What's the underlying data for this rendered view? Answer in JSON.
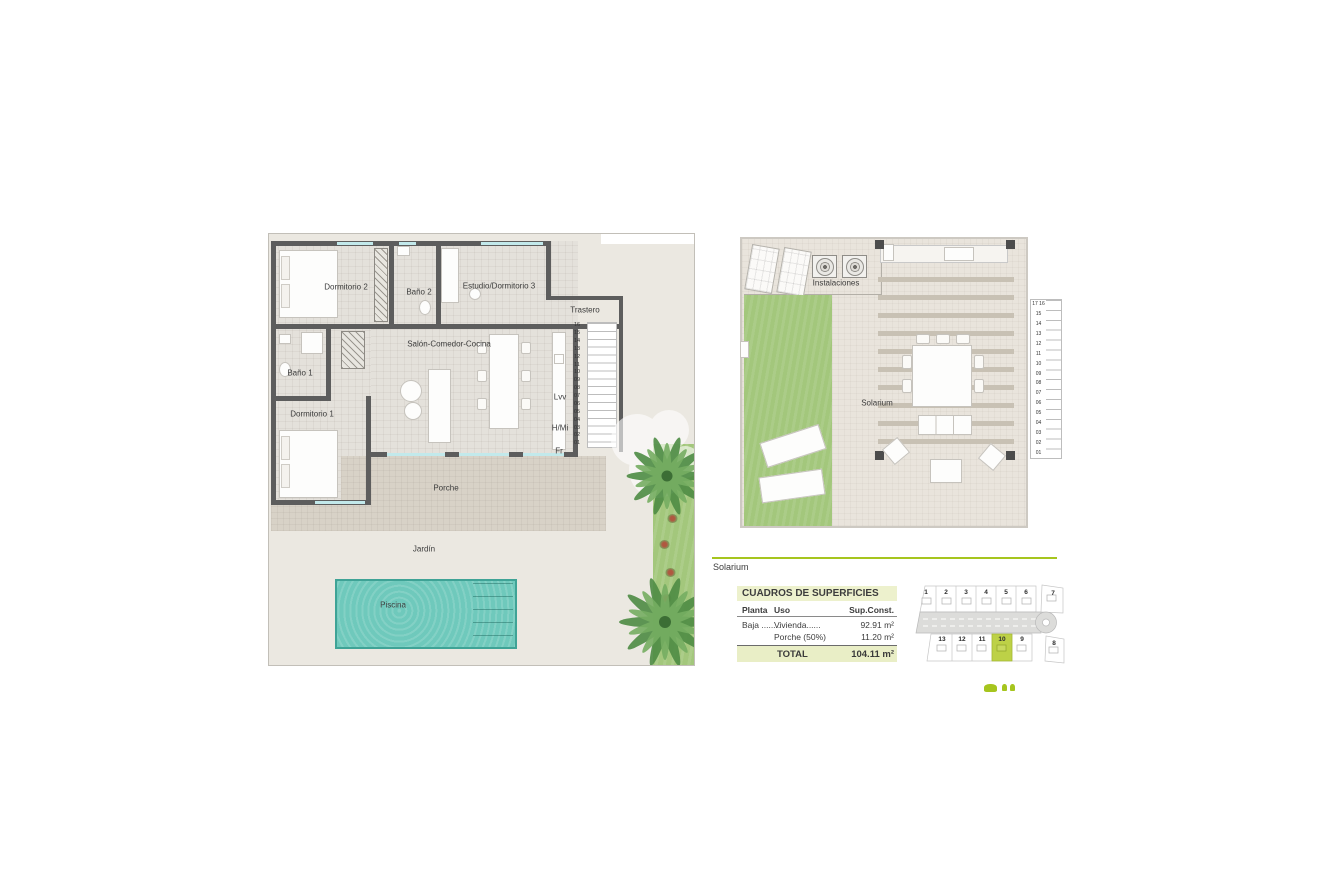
{
  "colors": {
    "accent_green": "#a6c51e",
    "table_header_bg": "#edf1cd",
    "table_total_bg": "#e9eec6",
    "plot_highlight": "#bdd147",
    "wall": "#5d5d5d",
    "floor": "#e4e1db",
    "garden": "#ebe8e1",
    "porch": "#d8d2c7",
    "window_glass": "#c2e9eb",
    "pool_water": "#6fc9bc",
    "pool_border": "#3fa396",
    "grass": "#a3c77c",
    "road": "#dcdcda"
  },
  "ground_plan": {
    "rooms": {
      "dormitorio2": "Dormitorio 2",
      "bano2": "Baño 2",
      "estudio_dormitorio3": "Estudio/Dormitorio 3",
      "trastero": "Trastero",
      "salon_comedor_cocina": "Salón-Comedor-Cocina",
      "bano1": "Baño 1",
      "dormitorio1": "Dormitorio 1",
      "porche": "Porche",
      "jardin": "Jardín",
      "piscina": "Piscina"
    },
    "appliances": {
      "dishwasher_label": "Lvv",
      "oven_micro_label": "H/Mi",
      "fridge_label": "Fr"
    },
    "stair_numbers": [
      "16",
      "15",
      "14",
      "13",
      "12",
      "11",
      "10",
      "09",
      "08",
      "07",
      "06",
      "05",
      "04",
      "03",
      "02",
      "01"
    ]
  },
  "roof_plan": {
    "rooms": {
      "instalaciones": "Instalaciones",
      "solarium": "Solarium"
    },
    "stair_numbers": [
      "17 16",
      "15",
      "14",
      "13",
      "12",
      "11",
      "10",
      "09",
      "08",
      "07",
      "06",
      "05",
      "04",
      "03",
      "02",
      "01"
    ]
  },
  "section_label": "Solarium",
  "surface_table": {
    "title": "CUADROS DE SUPERFICIES",
    "columns": {
      "planta": "Planta",
      "uso": "Uso",
      "sup": "Sup.Const."
    },
    "rows": [
      {
        "planta": "Baja ........",
        "uso": "Vivienda......",
        "sup": "92.91 m²"
      },
      {
        "planta": "",
        "uso": "Porche (50%)",
        "sup": "11.20 m²"
      }
    ],
    "total_label": "TOTAL",
    "total_value": "104.11 m²"
  },
  "site_plan": {
    "top_plots": [
      "1",
      "2",
      "3",
      "4",
      "5",
      "6",
      "7"
    ],
    "bottom_plots": [
      "13",
      "12",
      "11",
      "10",
      "9",
      "8"
    ],
    "highlighted_plot": "10"
  }
}
